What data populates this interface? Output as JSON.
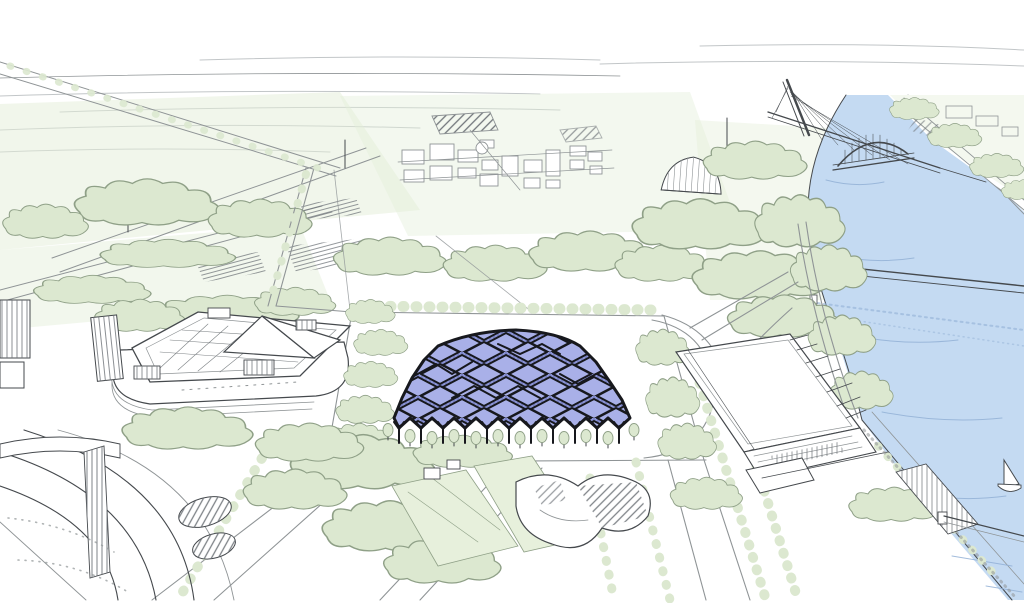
{
  "colors": {
    "paper": "#ffffff",
    "ink": "#45494d",
    "ink_light": "#8f9496",
    "sketch_faint": "#c2c6c8",
    "foliage": "#dce8d0",
    "foliage_stroke": "#8fa087",
    "foliage_wash": "#e3eed8",
    "lawn": "#e7f0dc",
    "river": "#c4daf2",
    "river_stroke": "#93b1d6",
    "canopy": "#a9b0e8",
    "canopy_side": "#8d96d8",
    "canopy_hatch": "#5d65a8",
    "canopy_line": "#17181d",
    "hatch": "#70757a"
  }
}
